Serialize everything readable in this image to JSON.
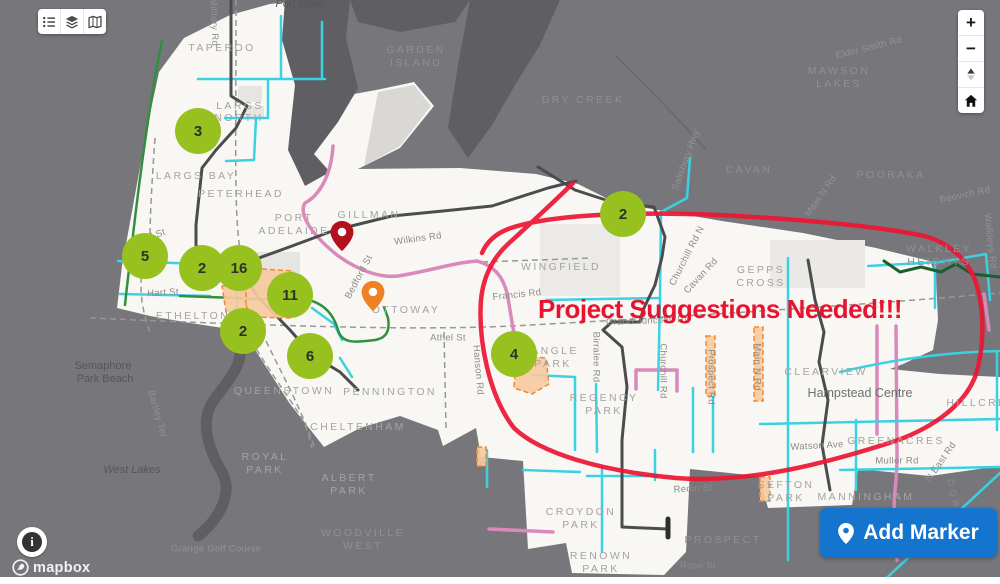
{
  "colors": {
    "annotation_red": "#e8142f",
    "cluster_green": "#97c11f",
    "button_blue": "#1574cd",
    "route_cyan": "#3ad1e2",
    "route_pink": "#d989ba",
    "route_dark": "#4c4c4e",
    "route_green": "#2f9040",
    "route_dark_green": "#1e5c32",
    "zone_orange": "#ee8a3b",
    "pin_dark_red": "#b2121e",
    "pin_orange": "#f08122"
  },
  "toolbar": {
    "buttons": [
      {
        "name": "list"
      },
      {
        "name": "layers"
      },
      {
        "name": "basemap"
      }
    ]
  },
  "map_controls": {
    "zoom_in": "+",
    "zoom_out": "−"
  },
  "annotation": {
    "text": "Project Suggestions Needed!!!"
  },
  "add_marker_button": {
    "label": "Add Marker"
  },
  "attribution": {
    "logo_text": "mapbox",
    "info_glyph": "i"
  },
  "map": {
    "suburb_labels_light": [
      {
        "text": "TAPEROO",
        "x": 222,
        "y": 48
      },
      {
        "text": "LARGS",
        "x": 240,
        "y": 106
      },
      {
        "text": "NORTH",
        "x": 239,
        "y": 118
      },
      {
        "text": "LARGS BAY",
        "x": 196,
        "y": 176
      },
      {
        "text": "PETERHEAD",
        "x": 241,
        "y": 194
      },
      {
        "text": "PORT",
        "x": 294,
        "y": 218
      },
      {
        "text": "ADELAIDE",
        "x": 294,
        "y": 231
      },
      {
        "text": "GILLMAN",
        "x": 369,
        "y": 215
      },
      {
        "text": "WINGFIELD",
        "x": 561,
        "y": 267
      },
      {
        "text": "GEPPS",
        "x": 761,
        "y": 270
      },
      {
        "text": "CROSS",
        "x": 761,
        "y": 283
      },
      {
        "text": "OTTOWAY",
        "x": 406,
        "y": 310
      },
      {
        "text": "ETHELTON",
        "x": 193,
        "y": 316
      },
      {
        "text": "ANGLE",
        "x": 555,
        "y": 351
      },
      {
        "text": "PARK",
        "x": 553,
        "y": 364
      },
      {
        "text": "REGENCY",
        "x": 604,
        "y": 398
      },
      {
        "text": "PARK",
        "x": 604,
        "y": 411
      },
      {
        "text": "QUEENSTOWN",
        "x": 284,
        "y": 391
      },
      {
        "text": "PENNINGTON",
        "x": 390,
        "y": 392
      },
      {
        "text": "CHELTENHAM",
        "x": 358,
        "y": 427
      },
      {
        "text": "ROYAL",
        "x": 265,
        "y": 457
      },
      {
        "text": "PARK",
        "x": 265,
        "y": 470
      },
      {
        "text": "ALBERT",
        "x": 349,
        "y": 478
      },
      {
        "text": "PARK",
        "x": 349,
        "y": 491
      },
      {
        "text": "CLEARVIEW",
        "x": 826,
        "y": 372
      },
      {
        "text": "HILLCREST",
        "x": 986,
        "y": 403
      },
      {
        "text": "GREENACRES",
        "x": 896,
        "y": 441
      },
      {
        "text": "SEFTON",
        "x": 786,
        "y": 485
      },
      {
        "text": "PARK",
        "x": 786,
        "y": 498
      },
      {
        "text": "CROYDON",
        "x": 581,
        "y": 512
      },
      {
        "text": "PARK",
        "x": 581,
        "y": 525
      },
      {
        "text": "RENOWN",
        "x": 601,
        "y": 556
      },
      {
        "text": "PARK",
        "x": 601,
        "y": 569
      },
      {
        "text": "MANNINGHAM",
        "x": 866,
        "y": 497
      }
    ],
    "suburb_labels_dark": [
      {
        "text": "GARDEN",
        "x": 416,
        "y": 50
      },
      {
        "text": "ISLAND",
        "x": 416,
        "y": 63
      },
      {
        "text": "DRY CREEK",
        "x": 583,
        "y": 100
      },
      {
        "text": "MAWSON",
        "x": 839,
        "y": 71
      },
      {
        "text": "LAKES",
        "x": 839,
        "y": 84
      },
      {
        "text": "CAVAN",
        "x": 749,
        "y": 170
      },
      {
        "text": "POORAKA",
        "x": 891,
        "y": 175
      },
      {
        "text": "WALKLEY",
        "x": 939,
        "y": 249
      },
      {
        "text": "HEIGHTS",
        "x": 939,
        "y": 262
      },
      {
        "text": "PROSPECT",
        "x": 723,
        "y": 540
      },
      {
        "text": "WOODVILLE",
        "x": 363,
        "y": 533
      },
      {
        "text": "WEST",
        "x": 363,
        "y": 546
      }
    ],
    "street_labels_light": [
      {
        "text": "Wilkins Rd",
        "x": 418,
        "y": 239,
        "rot": -8
      },
      {
        "text": "Bedford St",
        "x": 359,
        "y": 277,
        "rot": -62
      },
      {
        "text": "Hall St",
        "x": 151,
        "y": 237,
        "rot": -20
      },
      {
        "text": "Hart St",
        "x": 163,
        "y": 293,
        "rot": -3
      },
      {
        "text": "Francis Rd",
        "x": 517,
        "y": 295,
        "rot": -6
      },
      {
        "text": "Athel St",
        "x": 448,
        "y": 338,
        "rot": 0
      },
      {
        "text": "Grand Junction Rd",
        "x": 648,
        "y": 321,
        "rot": -2
      },
      {
        "text": "Birralee Rd",
        "x": 596,
        "y": 357,
        "rot": 90
      },
      {
        "text": "Churchill Rd",
        "x": 663,
        "y": 371,
        "rot": 90
      },
      {
        "text": "Churchill Rd N",
        "x": 687,
        "y": 256,
        "rot": -63
      },
      {
        "text": "Cavan Rd",
        "x": 701,
        "y": 276,
        "rot": -47
      },
      {
        "text": "Prospect Rd",
        "x": 711,
        "y": 377,
        "rot": 90
      },
      {
        "text": "Main N Rd",
        "x": 757,
        "y": 367,
        "rot": 90
      },
      {
        "text": "Watson Ave",
        "x": 817,
        "y": 446,
        "rot": -3
      },
      {
        "text": "Muller Rd",
        "x": 897,
        "y": 461,
        "rot": 0
      },
      {
        "text": "N East Rd",
        "x": 941,
        "y": 462,
        "rot": -55
      },
      {
        "text": "Redin St",
        "x": 693,
        "y": 489,
        "rot": -3
      },
      {
        "text": "Rose St",
        "x": 698,
        "y": 566,
        "rot": 0
      },
      {
        "text": "O G Rd",
        "x": 953,
        "y": 496,
        "rot": 78
      },
      {
        "text": "Hanson Rd",
        "x": 478,
        "y": 370,
        "rot": 85
      }
    ],
    "street_labels_dark": [
      {
        "text": "Elder Smith Rd",
        "x": 869,
        "y": 48,
        "rot": -14
      },
      {
        "text": "Salisbury Hwy",
        "x": 686,
        "y": 160,
        "rot": -70
      },
      {
        "text": "Main N Rd",
        "x": 821,
        "y": 196,
        "rot": -55
      },
      {
        "text": "Beovich Rd",
        "x": 965,
        "y": 195,
        "rot": -12
      },
      {
        "text": "Walkleys Rd",
        "x": 990,
        "y": 241,
        "rot": 84
      },
      {
        "text": "Bartley Ter",
        "x": 157,
        "y": 414,
        "rot": 74
      },
      {
        "text": "Grange Golf Course",
        "x": 216,
        "y": 549,
        "rot": 0
      },
      {
        "text": "Military Rd",
        "x": 214,
        "y": 22,
        "rot": 88
      }
    ],
    "place_labels": [
      {
        "text": "Semaphore",
        "x": 103,
        "y": 366
      },
      {
        "text": "Park Beach",
        "x": 105,
        "y": 379
      }
    ],
    "centre_labels": [
      {
        "text": "Hampstead Centre",
        "x": 860,
        "y": 393
      }
    ],
    "water_labels": [
      {
        "text": "West Lakes",
        "x": 132,
        "y": 470
      },
      {
        "text": "Port River",
        "x": 300,
        "y": 4
      }
    ],
    "cluster_markers": [
      {
        "label": "3",
        "x": 198,
        "y": 131
      },
      {
        "label": "5",
        "x": 145,
        "y": 256
      },
      {
        "label": "2",
        "x": 202,
        "y": 268
      },
      {
        "label": "16",
        "x": 239,
        "y": 268
      },
      {
        "label": "11",
        "x": 290,
        "y": 295
      },
      {
        "label": "2",
        "x": 243,
        "y": 331
      },
      {
        "label": "6",
        "x": 310,
        "y": 356
      },
      {
        "label": "2",
        "x": 623,
        "y": 214
      },
      {
        "label": "4",
        "x": 514,
        "y": 354
      }
    ],
    "pins": [
      {
        "name": "dark-red-pin",
        "color": "#b2121e",
        "x": 342,
        "y": 257
      },
      {
        "name": "orange-pin",
        "color": "#f08122",
        "x": 373,
        "y": 317
      }
    ]
  }
}
